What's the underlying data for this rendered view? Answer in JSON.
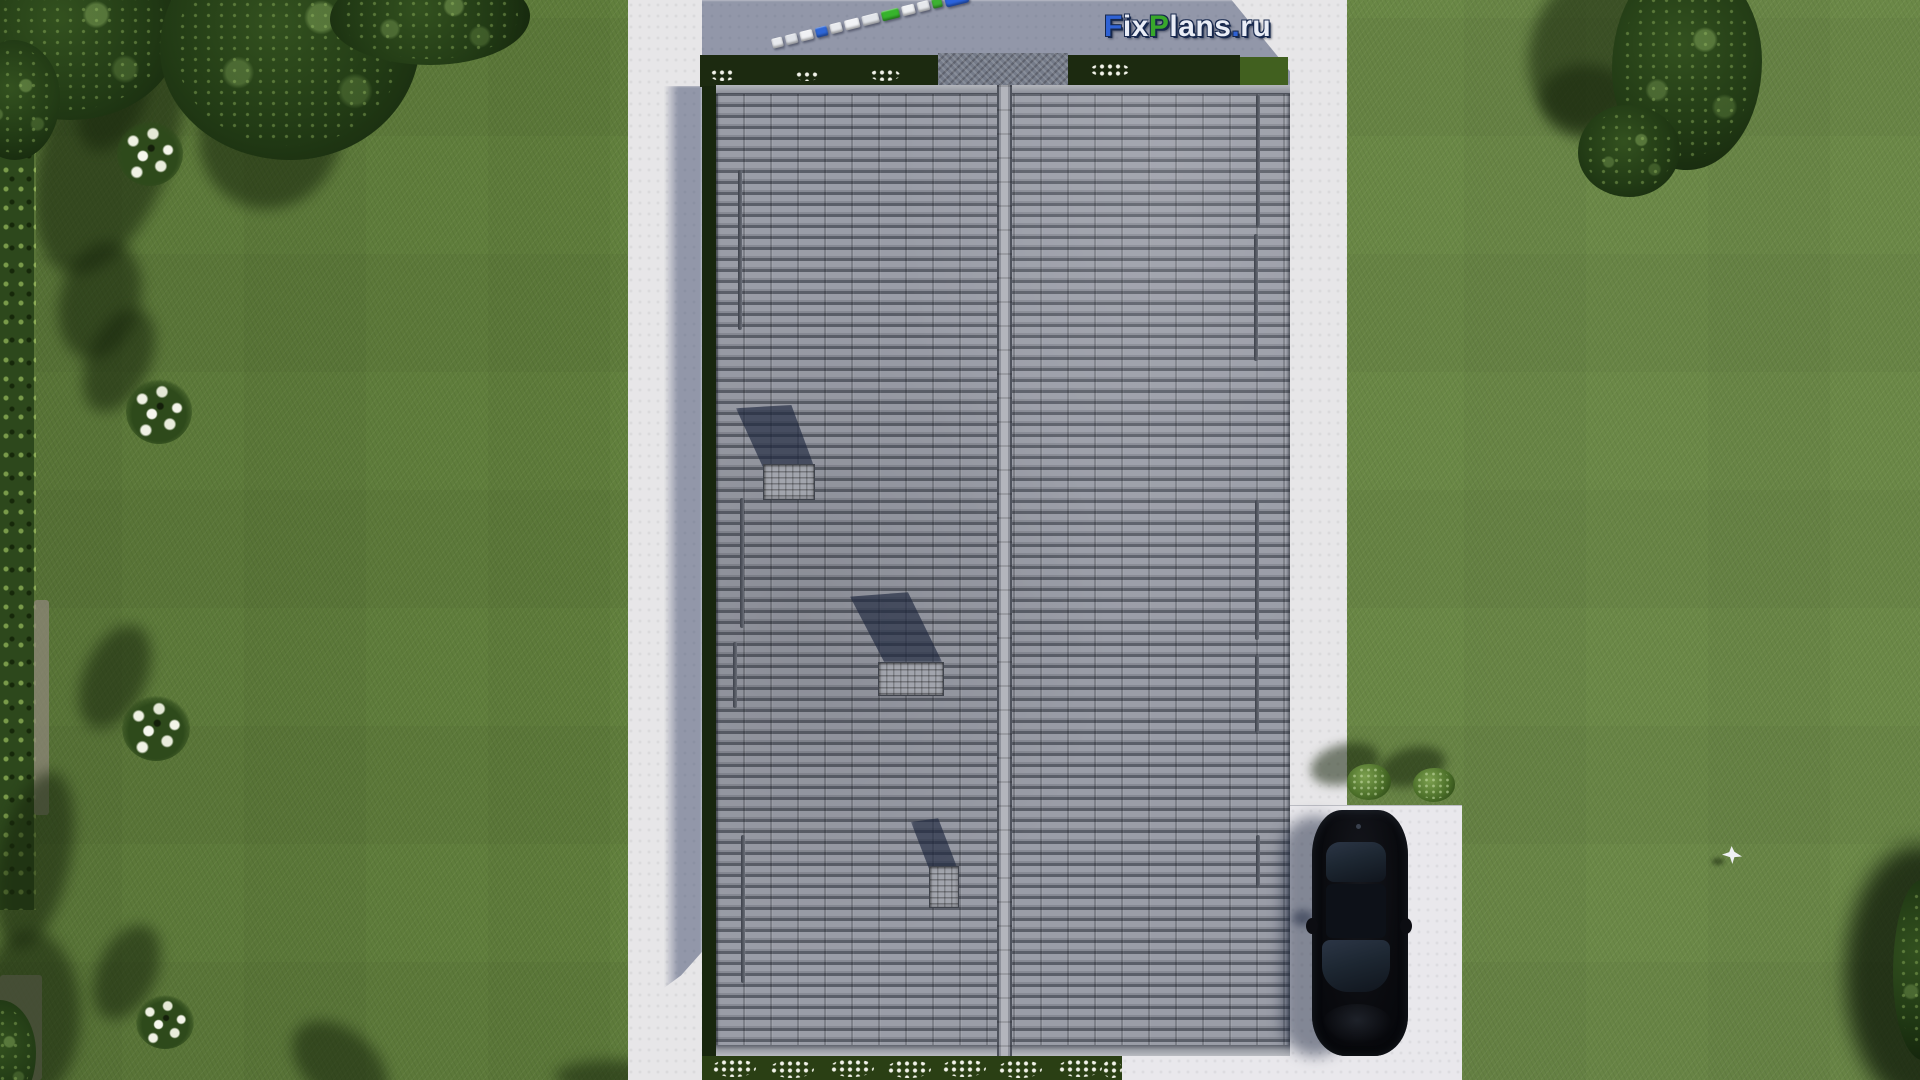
{
  "watermark": {
    "text": "FixPlans.ru",
    "segments": [
      {
        "text": "F",
        "color": "#2f62d4"
      },
      {
        "text": "ix",
        "color": "#e9edf6"
      },
      {
        "text": "P",
        "color": "#38a82b"
      },
      {
        "text": "lans",
        "color": "#e9edf6"
      },
      {
        "text": ".",
        "color": "#2f62d4"
      },
      {
        "text": "ru",
        "color": "#e9edf6"
      }
    ]
  },
  "train": {
    "segments": [
      "#e8eaee",
      "#dfe2e8",
      "#f0f1f4",
      "#2e66d6",
      "#e8eaee",
      "#f2f3f6",
      "#e2e5ea",
      "#37b42c",
      "#eff1f4",
      "#e6e8ec",
      "#3db232",
      "#2b63dd"
    ]
  },
  "colors": {
    "grass": "#63823e",
    "hedge": "#2d481c",
    "canopy": "#223b15",
    "canopy_dark": "#14250c",
    "tree_shadow": "rgba(22,36,11,0.55)",
    "path": "#e7e6e8",
    "path_shadow": "rgba(47,60,97,0.46)",
    "driveway": "#e9e8ec",
    "bed": "#1c2a10",
    "bed_lit": "#41601f",
    "gravel": "#757b89",
    "roof_base": "#888b96",
    "roof_light": "#9a9da7",
    "roof_mid": "#878a94",
    "roof_dark": "#5b5f69",
    "ridge": "#b3b5bc",
    "fascia": "#9a9da5",
    "chimney": "#a2a5ad",
    "car_body": "#0a0b0f",
    "car_glass": "#1d2732",
    "flower_white": "#f2f3ea",
    "bloom_green": "#2e4a1b"
  }
}
